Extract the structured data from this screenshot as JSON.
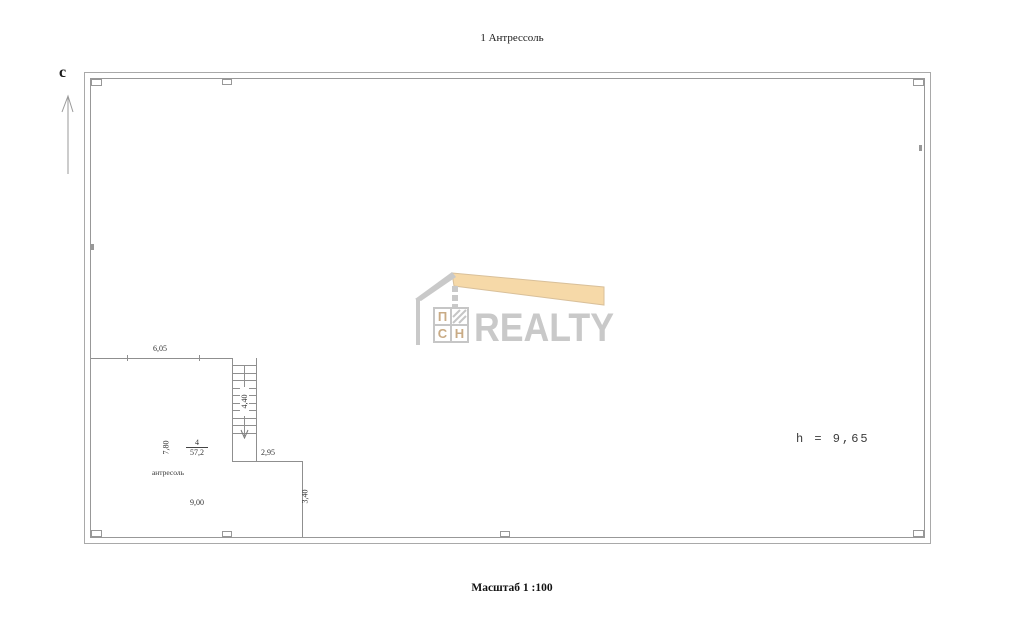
{
  "page": {
    "title": "1 Антрессоль",
    "scale_label": "Масштаб 1 :100",
    "north_label": "с",
    "height_note": "h = 9,65"
  },
  "room": {
    "number": "4",
    "area": "57,2",
    "name": "антресоль",
    "dim_top_width": "6,05",
    "dim_left_height": "7,80",
    "dim_bottom_width": "9,00",
    "dim_step_width": "2,95",
    "dim_right_height": "3,40",
    "dim_stairs_run": "4,40"
  },
  "watermark": {
    "brand": "REALTY",
    "monogram": [
      "П",
      "С",
      "Н"
    ],
    "roof_color": "#f6d9a8",
    "gray_color": "#c9c9c9"
  },
  "colors": {
    "wall_line": "#a0a0a0",
    "thin_line": "#8f8f8f",
    "text": "#2b2b2b"
  }
}
